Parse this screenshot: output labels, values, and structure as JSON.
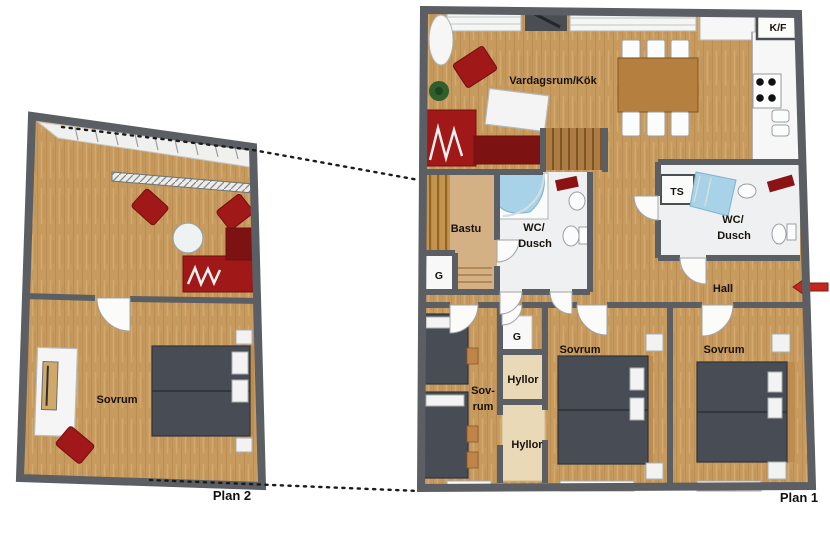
{
  "plan1": {
    "title": "Plan 1",
    "rooms": {
      "living": "Vardagsrum/Kök",
      "fridge_freezer": "K/F",
      "sauna": "Bastu",
      "wc1_line1": "WC/",
      "wc1_line2": "Dusch",
      "drying_cabinet": "TS",
      "wc2_line1": "WC/",
      "wc2_line2": "Dusch",
      "hall": "Hall",
      "closet_sauna": "G",
      "closet_hall": "G",
      "bedroom_small_line1": "Sov-",
      "bedroom_small_line2": "rum",
      "shelves1": "Hyllor",
      "shelves2": "Hyllor",
      "bedroom_mid": "Sovrum",
      "bedroom_right": "Sovrum"
    }
  },
  "plan2": {
    "title": "Plan 2",
    "rooms": {
      "bedroom": "Sovrum"
    }
  },
  "colors": {
    "wall": "#5b5e62",
    "floor": "#c79a5e",
    "sofa_red": "#a01818",
    "sofa_red_dark": "#7c1212",
    "bed_gray": "#484c54",
    "shower_blue": "#a8d2e8",
    "arrow_red": "#c0281e",
    "table_brown": "#b5803f",
    "plant_green": "#2f5f2b",
    "sauna_wood": "#d3b184",
    "shelf_cream": "#ead9b7"
  }
}
